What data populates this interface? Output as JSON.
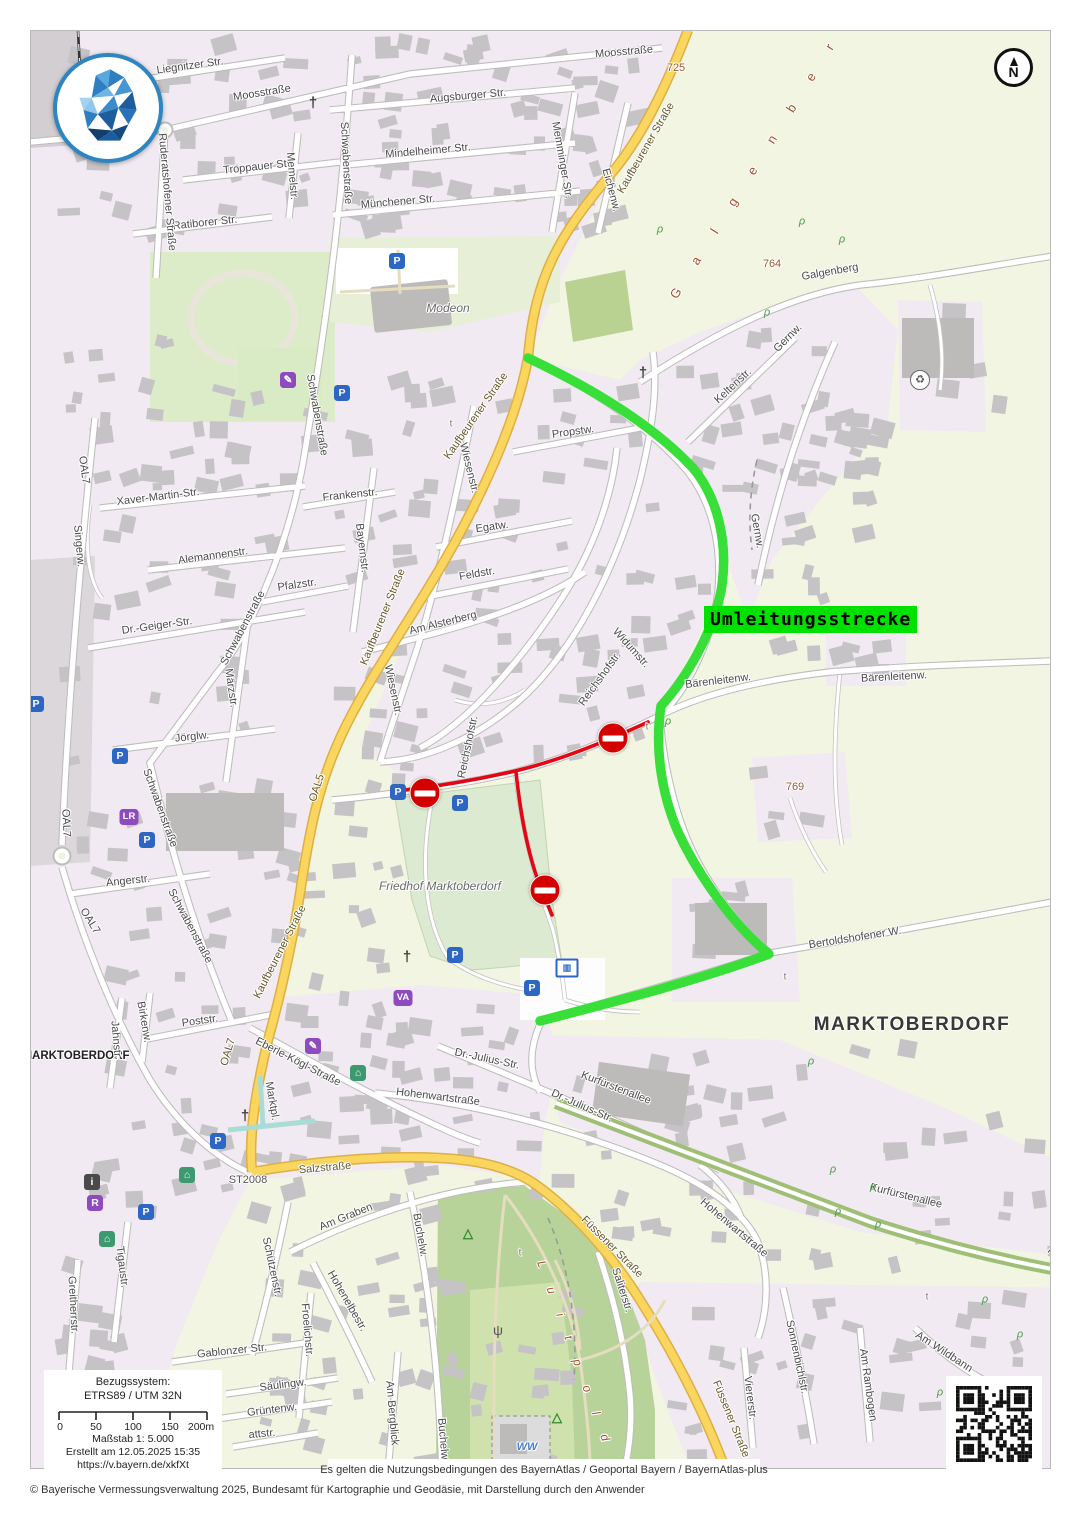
{
  "overlay": {
    "detour_label": "Umleitungsstrecke"
  },
  "colors": {
    "detour_label_bg": "#00e100",
    "route_green": "#39df39",
    "route_red": "#e30613",
    "no_entry_red": "#d40000",
    "main_road_yellow": "#fad65f"
  },
  "compass": {
    "letter": "N"
  },
  "attribution": {
    "terms": "Es gelten die Nutzungsbedingungen des BayernAtlas / Geoportal Bayern / BayernAtlas-plus",
    "copyright": "© Bayerische Vermessungsverwaltung 2025, Bundesamt für Kartographie und Geodäsie, mit Darstellung durch den Anwender"
  },
  "scale_box": {
    "ref_label": "Bezugssystem:",
    "ref_value": "ETRS89 / UTM 32N",
    "ticks": [
      "0",
      "50",
      "100",
      "150",
      "200m"
    ],
    "scale": "Maßstab 1: 5.000",
    "created": "Erstellt am 12.05.2025 15:35",
    "url": "https://v.bayern.de/xkfXt"
  },
  "map": {
    "labels": [
      {
        "t": "Liegnitzer Str.",
        "x": 190,
        "y": 66,
        "r": -8
      },
      {
        "t": "Moosstraße",
        "x": 262,
        "y": 93,
        "r": -9
      },
      {
        "t": "Moosstraße",
        "x": 624,
        "y": 52,
        "r": -5
      },
      {
        "t": "Augsburger Str.",
        "x": 468,
        "y": 96,
        "r": -5
      },
      {
        "t": "Mindelheimer Str.",
        "x": 428,
        "y": 151,
        "r": -5
      },
      {
        "t": "Münchener Str.",
        "x": 398,
        "y": 202,
        "r": -5
      },
      {
        "t": "Troppauer Str.",
        "x": 258,
        "y": 167,
        "r": -6
      },
      {
        "t": "Ratiborer Str.",
        "x": 205,
        "y": 223,
        "r": -6
      },
      {
        "t": "Memelstr.",
        "x": 292,
        "y": 176,
        "r": 85
      },
      {
        "t": "Memminger Str.",
        "x": 562,
        "y": 160,
        "r": 80
      },
      {
        "t": "Eichenw.",
        "x": 611,
        "y": 190,
        "r": 75
      },
      {
        "t": "Ruderatshofener Straße",
        "x": 167,
        "y": 192,
        "r": 85
      },
      {
        "t": "Schwabenstraße",
        "x": 346,
        "y": 163,
        "r": 87
      },
      {
        "t": "Schwabenstraße",
        "x": 317,
        "y": 415,
        "r": 80
      },
      {
        "t": "Schwabenstraße",
        "x": 243,
        "y": 628,
        "r": -62
      },
      {
        "t": "Schwabenstraße",
        "x": 160,
        "y": 808,
        "r": 70
      },
      {
        "t": "Schwabenstraße",
        "x": 190,
        "y": 926,
        "r": 62
      },
      {
        "t": "Kaufbeurener Straße",
        "x": 646,
        "y": 148,
        "r": -60,
        "c": "yroad"
      },
      {
        "t": "Kaufbeurener Straße",
        "x": 476,
        "y": 416,
        "r": -55,
        "c": "yroad"
      },
      {
        "t": "Kaufbeurener Straße",
        "x": 383,
        "y": 617,
        "r": -68,
        "c": "yroad"
      },
      {
        "t": "Kaufbeurener Straße",
        "x": 280,
        "y": 952,
        "r": -63,
        "c": "yroad"
      },
      {
        "t": "OAL5",
        "x": 317,
        "y": 788,
        "r": -72,
        "c": "yroad"
      },
      {
        "t": "OAL7",
        "x": 84,
        "y": 470,
        "r": 82
      },
      {
        "t": "OAL7",
        "x": 66,
        "y": 823,
        "r": 87
      },
      {
        "t": "OAL7",
        "x": 90,
        "y": 921,
        "r": 58
      },
      {
        "t": "OAL7",
        "x": 228,
        "y": 1052,
        "r": -74,
        "c": "yroad"
      },
      {
        "t": "725",
        "x": 676,
        "y": 68,
        "r": 0,
        "c": "elev"
      },
      {
        "t": "764",
        "x": 772,
        "y": 264,
        "r": 0,
        "c": "elev"
      },
      {
        "t": "769",
        "x": 795,
        "y": 787,
        "r": 0,
        "c": "elev"
      },
      {
        "t": "G a l g e n b e r g",
        "x": 765,
        "y": 150,
        "r": -58,
        "c": "nat"
      },
      {
        "t": "Galgenberg",
        "x": 830,
        "y": 272,
        "r": -10
      },
      {
        "t": "Gernw.",
        "x": 788,
        "y": 338,
        "r": -45
      },
      {
        "t": "Gernw.",
        "x": 757,
        "y": 531,
        "r": 80
      },
      {
        "t": "Keltenstr.",
        "x": 733,
        "y": 386,
        "r": -43
      },
      {
        "t": "Propstw.",
        "x": 573,
        "y": 432,
        "r": -8
      },
      {
        "t": "Wiesenstr.",
        "x": 469,
        "y": 468,
        "r": 76
      },
      {
        "t": "Wiesenstr.",
        "x": 393,
        "y": 690,
        "r": 78
      },
      {
        "t": "Frankenstr.",
        "x": 350,
        "y": 495,
        "r": -6
      },
      {
        "t": "Egatw.",
        "x": 492,
        "y": 527,
        "r": -8
      },
      {
        "t": "Feldstr.",
        "x": 477,
        "y": 574,
        "r": -10
      },
      {
        "t": "Am Alsterberg",
        "x": 443,
        "y": 623,
        "r": -14
      },
      {
        "t": "Bayernstr.",
        "x": 362,
        "y": 548,
        "r": 83
      },
      {
        "t": "Xaver-Martin-Str.",
        "x": 158,
        "y": 497,
        "r": -7
      },
      {
        "t": "Singerw.",
        "x": 79,
        "y": 546,
        "r": 85
      },
      {
        "t": "Alemannenstr.",
        "x": 213,
        "y": 556,
        "r": -8
      },
      {
        "t": "Pfalzstr.",
        "x": 297,
        "y": 585,
        "r": -8
      },
      {
        "t": "Dr.-Geiger-Str.",
        "x": 157,
        "y": 626,
        "r": -8
      },
      {
        "t": "Märzstr.",
        "x": 231,
        "y": 688,
        "r": 82
      },
      {
        "t": "Reichshofstr.",
        "x": 468,
        "y": 747,
        "r": -78
      },
      {
        "t": "Reichshofstr.",
        "x": 600,
        "y": 679,
        "r": -54
      },
      {
        "t": "Widumstr.",
        "x": 631,
        "y": 648,
        "r": 48
      },
      {
        "t": "Bärenleitenw.",
        "x": 718,
        "y": 681,
        "r": -7
      },
      {
        "t": "Bärenleitenw.",
        "x": 894,
        "y": 677,
        "r": -3
      },
      {
        "t": "Jörglw.",
        "x": 192,
        "y": 737,
        "r": -6
      },
      {
        "t": "Angerstr.",
        "x": 128,
        "y": 881,
        "r": -6
      },
      {
        "t": "Friedhof Marktoberdorf",
        "x": 440,
        "y": 886,
        "r": 0,
        "c": "ital"
      },
      {
        "t": "Bertoldshofener W.",
        "x": 855,
        "y": 938,
        "r": -9
      },
      {
        "t": "MARKTOBERDORF",
        "x": 912,
        "y": 1025,
        "r": 0,
        "c": "big"
      },
      {
        "t": "MARKTOBERDORF",
        "x": 76,
        "y": 1056,
        "r": 0,
        "c": "city"
      },
      {
        "t": "Poststr.",
        "x": 200,
        "y": 1021,
        "r": -8
      },
      {
        "t": "Birkenw.",
        "x": 144,
        "y": 1022,
        "r": 80
      },
      {
        "t": "Jahnstr.",
        "x": 116,
        "y": 1040,
        "r": 85
      },
      {
        "t": "Eberle-Kögl-Straße",
        "x": 298,
        "y": 1062,
        "r": 27
      },
      {
        "t": "Marktpl.",
        "x": 272,
        "y": 1101,
        "r": 80
      },
      {
        "t": "Hohenwartstraße",
        "x": 438,
        "y": 1097,
        "r": 7
      },
      {
        "t": "Hohenwartstraße",
        "x": 734,
        "y": 1228,
        "r": 40
      },
      {
        "t": "Dr.-Julius-Str.",
        "x": 487,
        "y": 1059,
        "r": 12
      },
      {
        "t": "Dr.-Julius-Str.",
        "x": 582,
        "y": 1106,
        "r": 24
      },
      {
        "t": "Kurfürstenallee",
        "x": 616,
        "y": 1088,
        "r": 21
      },
      {
        "t": "Kurfürstenallee",
        "x": 906,
        "y": 1196,
        "r": 14
      },
      {
        "t": "Kurfürstenallee",
        "x": 1078,
        "y": 1272,
        "r": 38
      },
      {
        "t": "Salzstraße",
        "x": 325,
        "y": 1168,
        "r": -5,
        "c": "yroad"
      },
      {
        "t": "ST2008",
        "x": 248,
        "y": 1180,
        "r": 0,
        "c": "ref"
      },
      {
        "t": "Am Graben",
        "x": 346,
        "y": 1217,
        "r": -22
      },
      {
        "t": "Füssener Straße",
        "x": 612,
        "y": 1247,
        "r": 45,
        "c": "yroad"
      },
      {
        "t": "Füssener Straße",
        "x": 731,
        "y": 1419,
        "r": 68,
        "c": "yroad"
      },
      {
        "t": "Schützenstr.",
        "x": 272,
        "y": 1267,
        "r": 78
      },
      {
        "t": "Hohenelbestr.",
        "x": 347,
        "y": 1301,
        "r": 60
      },
      {
        "t": "Froelichstr.",
        "x": 307,
        "y": 1330,
        "r": 85
      },
      {
        "t": "Gablonzer Str.",
        "x": 232,
        "y": 1351,
        "r": -6
      },
      {
        "t": "Tigaustr.",
        "x": 122,
        "y": 1267,
        "r": 83
      },
      {
        "t": "Greitherrstr.",
        "x": 73,
        "y": 1305,
        "r": 87
      },
      {
        "t": "Säulingw.",
        "x": 283,
        "y": 1385,
        "r": -7
      },
      {
        "t": "Grüntenw.",
        "x": 272,
        "y": 1410,
        "r": -7
      },
      {
        "t": "attstr.",
        "x": 262,
        "y": 1434,
        "r": -5
      },
      {
        "t": "Am Bergblick",
        "x": 392,
        "y": 1413,
        "r": 85
      },
      {
        "t": "Buchelw.",
        "x": 420,
        "y": 1235,
        "r": 80
      },
      {
        "t": "Buchelw.",
        "x": 443,
        "y": 1440,
        "r": 85
      },
      {
        "t": "Saliterstr.",
        "x": 622,
        "y": 1290,
        "r": 72
      },
      {
        "t": "Sonnenbichlstr.",
        "x": 797,
        "y": 1357,
        "r": 78
      },
      {
        "t": "Viererstr.",
        "x": 750,
        "y": 1398,
        "r": 83
      },
      {
        "t": "Am Rambogen",
        "x": 868,
        "y": 1385,
        "r": 82
      },
      {
        "t": "Am Wildbann",
        "x": 944,
        "y": 1352,
        "r": 33
      },
      {
        "t": "L u i t p o l d",
        "x": 575,
        "y": 1355,
        "r": 70,
        "c": "nat2"
      },
      {
        "t": "Modeon",
        "x": 448,
        "y": 308,
        "r": 0,
        "c": "ital"
      },
      {
        "t": "WW",
        "x": 527,
        "y": 1447,
        "r": 0,
        "c": "water"
      },
      {
        "t": "t",
        "x": 647,
        "y": 727,
        "r": 0,
        "c": "tiny"
      },
      {
        "t": "t",
        "x": 451,
        "y": 424,
        "r": 0,
        "c": "tiny"
      },
      {
        "t": "t",
        "x": 785,
        "y": 977,
        "r": 0,
        "c": "tiny"
      },
      {
        "t": "t",
        "x": 927,
        "y": 1297,
        "r": 0,
        "c": "tiny"
      },
      {
        "t": "t",
        "x": 520,
        "y": 1253,
        "r": 0,
        "c": "tiny"
      }
    ],
    "icons": [
      {
        "t": "parking",
        "x": 397,
        "y": 261
      },
      {
        "t": "parking",
        "x": 342,
        "y": 393
      },
      {
        "t": "parking",
        "x": 36,
        "y": 704
      },
      {
        "t": "parking",
        "x": 120,
        "y": 756
      },
      {
        "t": "parking",
        "x": 147,
        "y": 840
      },
      {
        "t": "parking",
        "x": 398,
        "y": 792
      },
      {
        "t": "parking",
        "x": 460,
        "y": 803
      },
      {
        "t": "parking",
        "x": 455,
        "y": 955
      },
      {
        "t": "parking",
        "x": 532,
        "y": 988
      },
      {
        "t": "parking",
        "x": 218,
        "y": 1141
      },
      {
        "t": "parking",
        "x": 146,
        "y": 1212
      },
      {
        "t": "lr",
        "x": 129,
        "y": 817
      },
      {
        "t": "r",
        "x": 95,
        "y": 1203
      },
      {
        "t": "info",
        "x": 92,
        "y": 1182
      },
      {
        "t": "museum",
        "x": 358,
        "y": 1073
      },
      {
        "t": "museum",
        "x": 187,
        "y": 1175
      },
      {
        "t": "museum",
        "x": 107,
        "y": 1239
      },
      {
        "t": "pencil",
        "x": 313,
        "y": 1046
      },
      {
        "t": "pencil",
        "x": 288,
        "y": 380
      },
      {
        "t": "va",
        "x": 403,
        "y": 998
      },
      {
        "t": "bus",
        "x": 567,
        "y": 968
      },
      {
        "t": "recycle",
        "x": 920,
        "y": 380
      },
      {
        "t": "church",
        "x": 313,
        "y": 103
      },
      {
        "t": "church",
        "x": 643,
        "y": 373
      },
      {
        "t": "church",
        "x": 245,
        "y": 1116
      },
      {
        "t": "church",
        "x": 407,
        "y": 957
      },
      {
        "t": "antenna",
        "x": 498,
        "y": 1330
      },
      {
        "t": "view",
        "x": 468,
        "y": 1233
      },
      {
        "t": "view",
        "x": 557,
        "y": 1417
      },
      {
        "t": "tree",
        "x": 660,
        "y": 230
      },
      {
        "t": "tree",
        "x": 802,
        "y": 222
      },
      {
        "t": "tree",
        "x": 842,
        "y": 240
      },
      {
        "t": "tree",
        "x": 767,
        "y": 313
      },
      {
        "t": "tree",
        "x": 668,
        "y": 722
      },
      {
        "t": "tree",
        "x": 811,
        "y": 1062
      },
      {
        "t": "tree",
        "x": 833,
        "y": 1170
      },
      {
        "t": "tree",
        "x": 873,
        "y": 1187
      },
      {
        "t": "tree",
        "x": 838,
        "y": 1212
      },
      {
        "t": "tree",
        "x": 878,
        "y": 1225
      },
      {
        "t": "tree",
        "x": 985,
        "y": 1300
      },
      {
        "t": "tree",
        "x": 1020,
        "y": 1335
      },
      {
        "t": "tree",
        "x": 940,
        "y": 1393
      }
    ],
    "no_entry_signs": [
      {
        "x": 425,
        "y": 793
      },
      {
        "x": 613,
        "y": 738
      },
      {
        "x": 545,
        "y": 890
      }
    ]
  }
}
